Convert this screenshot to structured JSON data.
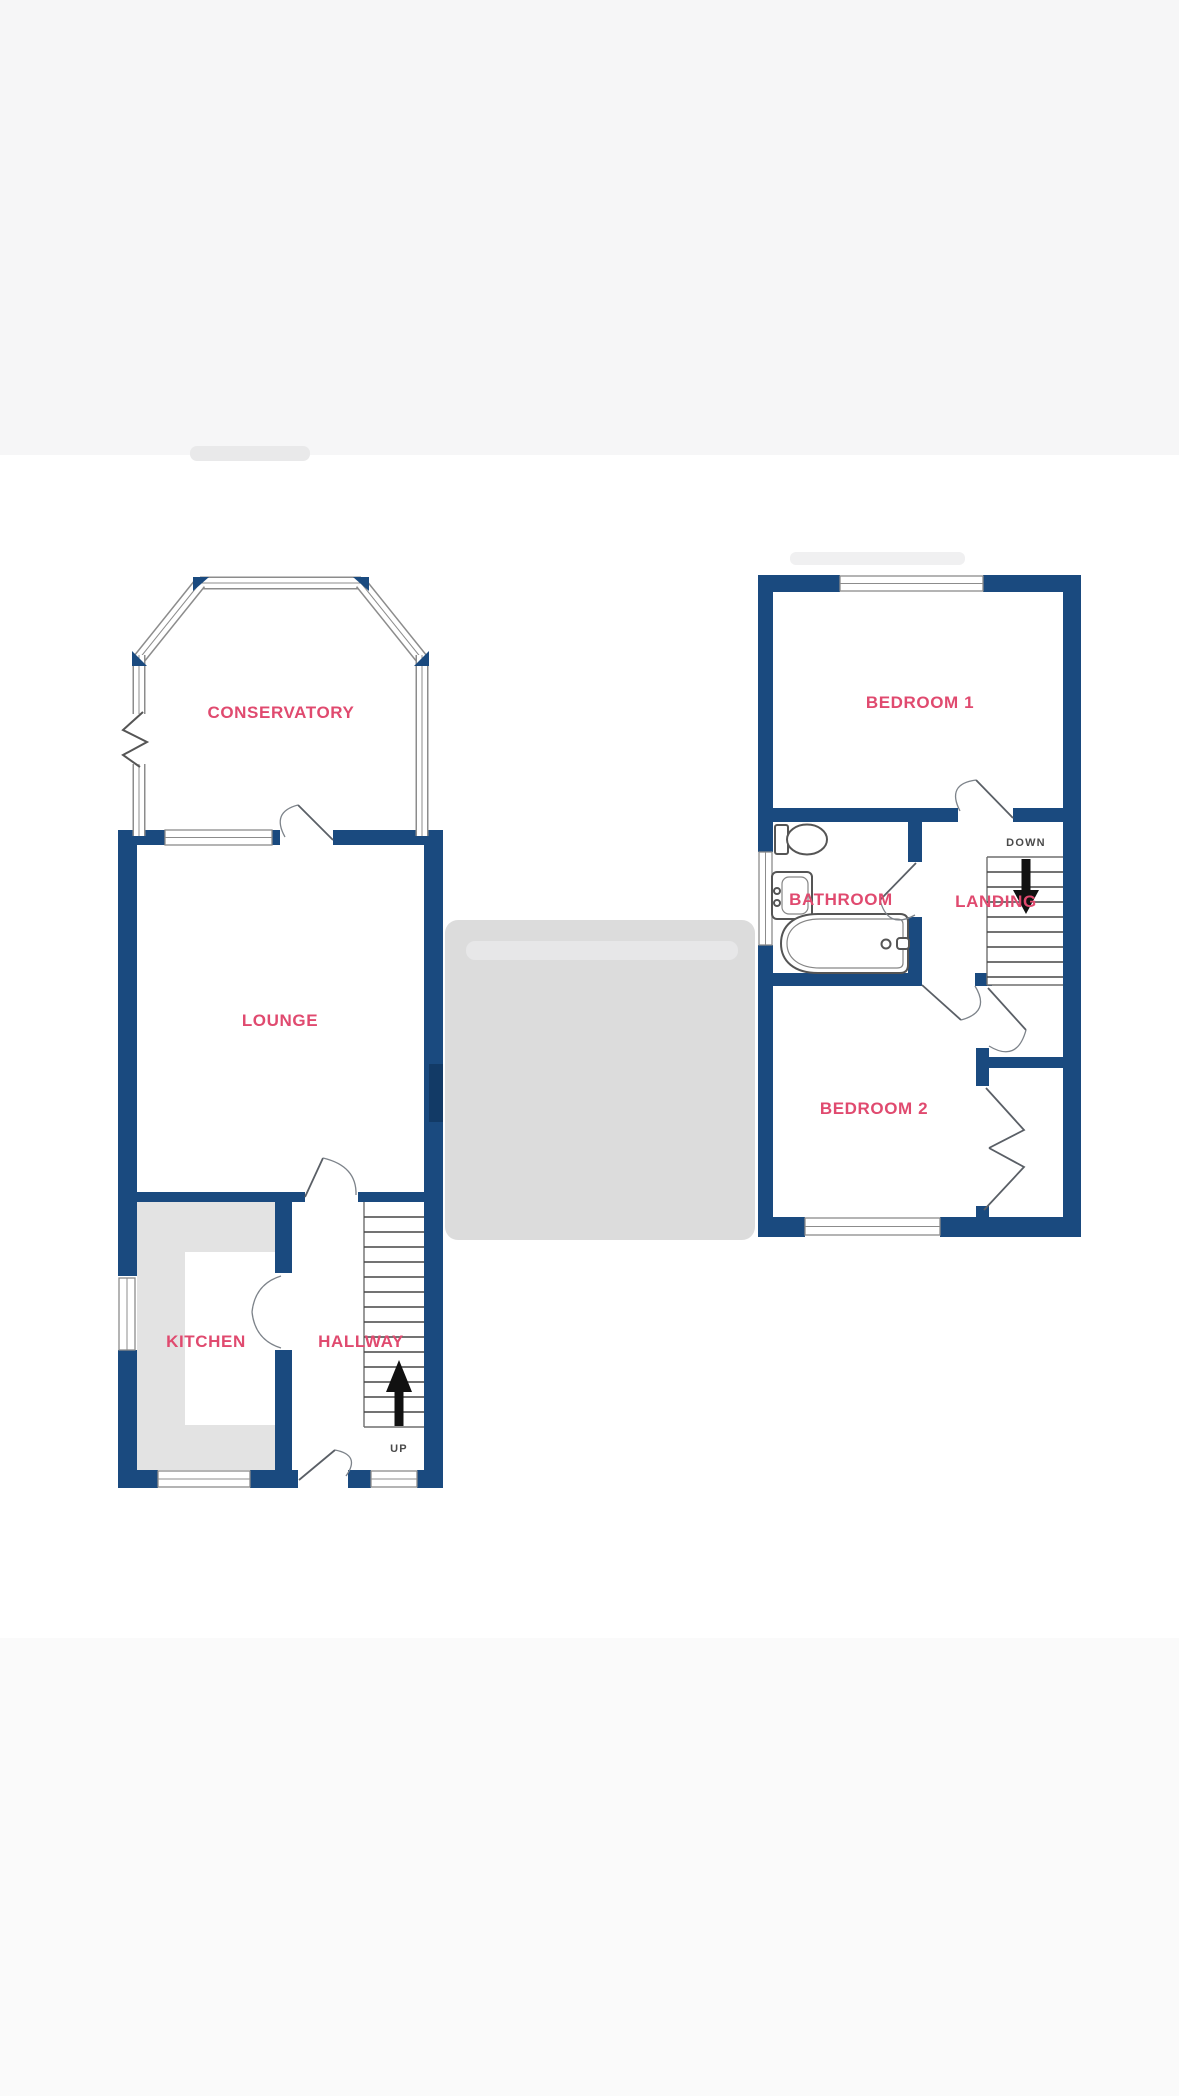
{
  "image_type": "floor-plan",
  "floors": {
    "ground": {
      "name": "ground-floor",
      "rooms": {
        "conservatory": "CONSERVATORY",
        "lounge": "LOUNGE",
        "kitchen": "KITCHEN",
        "hallway": "HALLWAY"
      },
      "stairs_label": "UP"
    },
    "first": {
      "name": "first-floor",
      "rooms": {
        "bedroom1": "BEDROOM 1",
        "bathroom": "BATHROOM",
        "landing": "LANDING",
        "bedroom2": "BEDROOM 2"
      },
      "stairs_label": "DOWN"
    }
  },
  "colors": {
    "wall": "#1a4a7f",
    "room_label": "#e04a6f",
    "direction_label": "#4a4a4a",
    "window_outline": "#8c8c8c",
    "fixture_outline": "#555555",
    "kitchen_counter": "#e3e3e3",
    "placeholder_block": "#dcdcdc",
    "top_band": "#f6f6f7",
    "bottom_band": "#fafafa"
  }
}
